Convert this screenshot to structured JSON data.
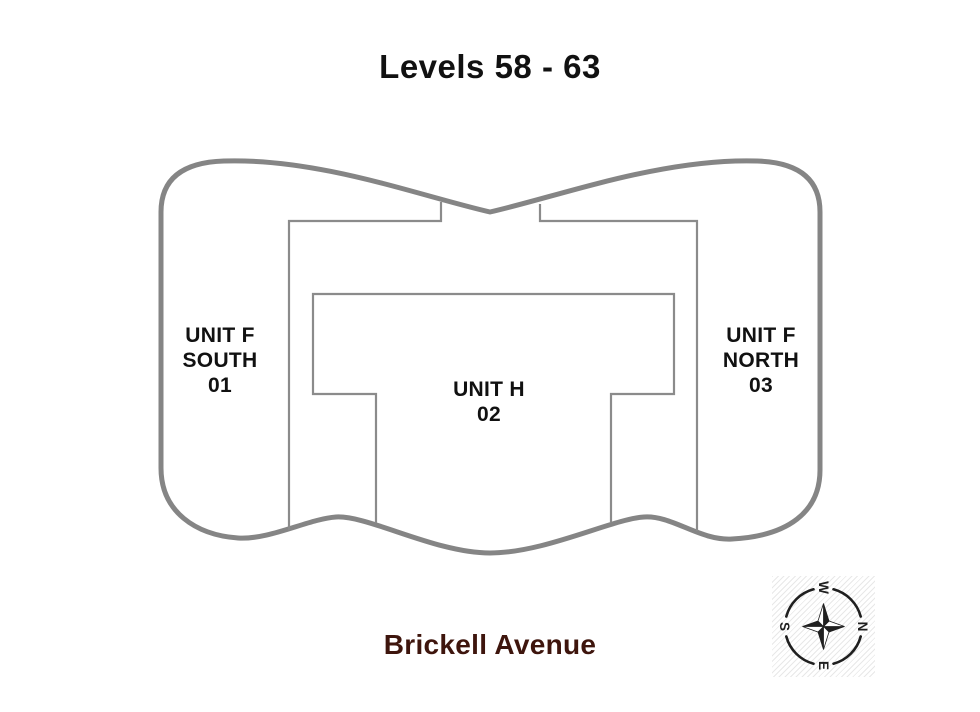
{
  "page": {
    "title": "Levels 58 - 63"
  },
  "units": [
    {
      "name": "Unit F South",
      "number": "01",
      "label": "UNIT F\nSOUTH\n01"
    },
    {
      "name": "Unit H",
      "number": "02",
      "label": "UNIT H\n02"
    },
    {
      "name": "Unit F North",
      "number": "03",
      "label": "UNIT F\nNORTH\n03"
    }
  ],
  "street": {
    "label": "Brickell Avenue"
  },
  "compass": {
    "west": "W",
    "north": "N",
    "east": "E",
    "south": "S",
    "rotation_deg": 90
  },
  "colors": {
    "background": "#ffffff",
    "outer_outline": "#858585",
    "inner_walls": "#8b8b8b",
    "title_text": "#111111",
    "street_text": "#3e150d",
    "compass": "#1f1f1f"
  }
}
